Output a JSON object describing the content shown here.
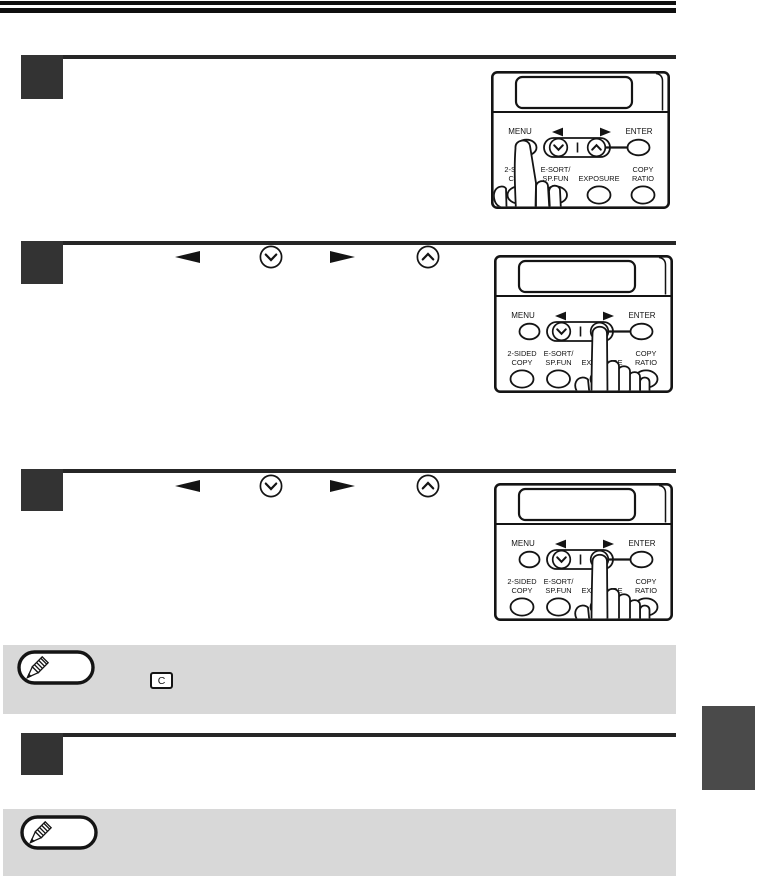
{
  "page": {
    "kind": "copier operation manual page with numbered steps and control-panel illustrations"
  },
  "control_panel": {
    "menu_label": "MENU",
    "enter_label": "ENTER",
    "two_sided_line1": "2-SIDED",
    "two_sided_line2": "COPY",
    "esort_line1": "E-SORT/",
    "esort_line2": "SP.FUN",
    "exposure_label": "EXPOSURE",
    "ratio_line1": "COPY",
    "ratio_line2": "RATIO"
  },
  "steps": [
    {
      "pressed_button": "MENU"
    },
    {
      "pressed_button": "right scroll key"
    },
    {
      "pressed_button": "right scroll key"
    },
    {
      "pressed_button": null
    }
  ],
  "inline_key_icons": [
    "left-arrow",
    "down-scroll",
    "right-arrow",
    "up-scroll"
  ],
  "notes": [
    {
      "badge_icon": "pencil-icon",
      "clear_key_label": "C"
    },
    {
      "badge_icon": "pencil-icon"
    }
  ],
  "colors": {
    "bar_black": "#0f0f0f",
    "step_square": "#333333",
    "rule": "#262626",
    "note_bg": "#d8d8d8",
    "tab_gray": "#4a4a4a",
    "ink": "#141414",
    "paper": "#ffffff"
  }
}
